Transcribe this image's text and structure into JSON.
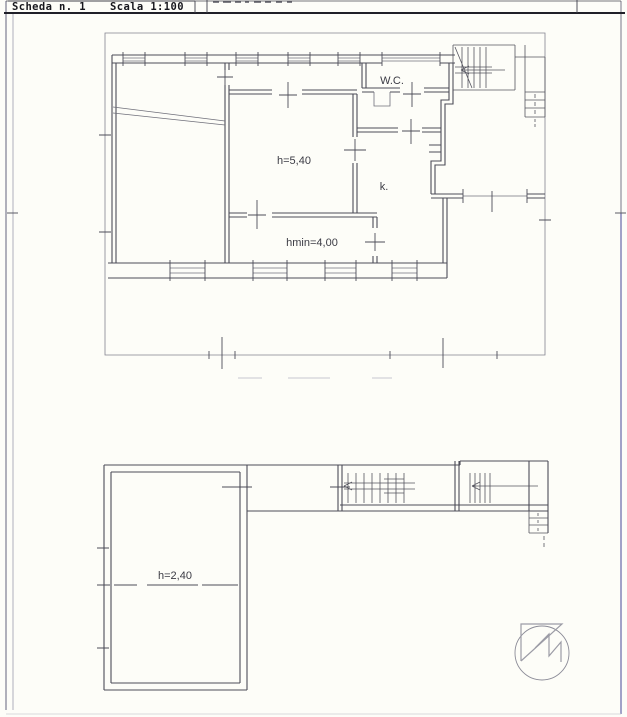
{
  "page": {
    "title_block": {
      "sheet": "Scheda n. 1",
      "scale": "Scala 1:100"
    },
    "colors": {
      "paper": "#fdfdf8",
      "wall_line": "#4d4d58",
      "thin_line": "#83838f",
      "border_blue": "#6767a8",
      "header_rule": "#202028"
    }
  },
  "floor_plans": {
    "ground": {
      "labels": {
        "wc": "W.C.",
        "hall_height": "h=5,40",
        "kitchen": "k.",
        "min_height": "hmin=4,00"
      }
    },
    "basement": {
      "labels": {
        "height": "h=2,40"
      }
    }
  }
}
